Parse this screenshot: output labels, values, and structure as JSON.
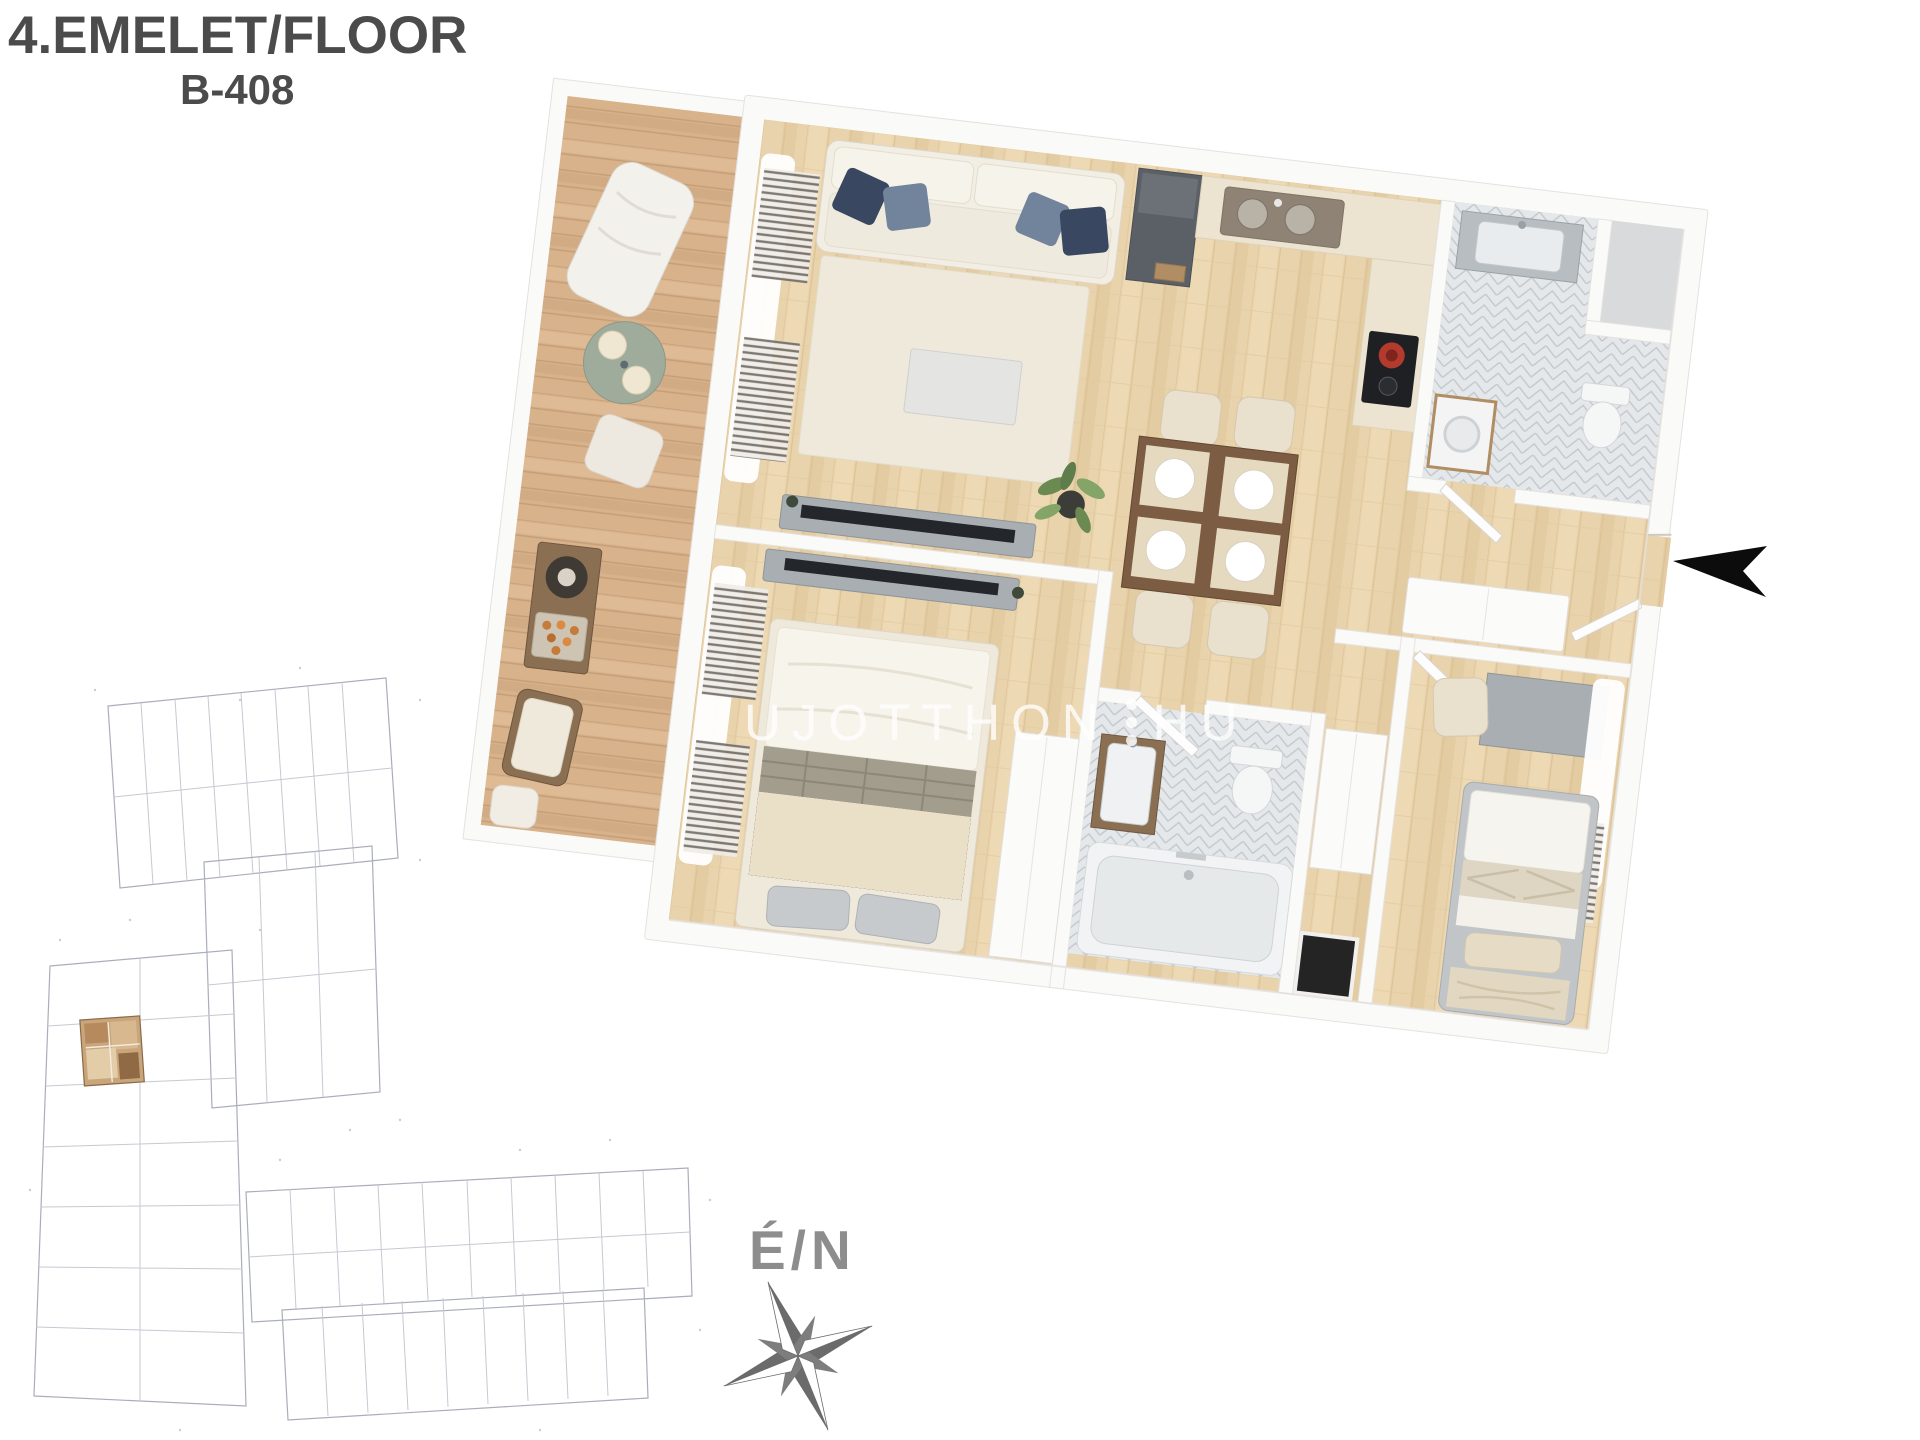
{
  "page": {
    "background": "#ffffff"
  },
  "header": {
    "title": "4.EMELET/FLOOR",
    "unit_code": "B-408",
    "text_color": "#4b4b4b"
  },
  "watermark": {
    "part1": "UJOTTHON",
    "part2": "HU",
    "separator": "vertical-three-dots",
    "color": "#ffffff"
  },
  "compass": {
    "label": "É/N",
    "icon": "compass-rose-icon",
    "label_color": "#8d8d8d",
    "star_color": "#6b6b6b"
  },
  "entrance_arrow": {
    "icon": "entrance-arrow-icon",
    "direction": "left",
    "color": "#0c0c0c"
  },
  "floorplan": {
    "type": "3d-apartment-top-view",
    "rotation_deg": 6.8,
    "rooms": [
      "terrace",
      "living-room",
      "kitchen",
      "dining-area",
      "bathroom-1",
      "storage-closet",
      "hallway",
      "bedroom-1",
      "bathroom-2",
      "bedroom-2"
    ],
    "colors": {
      "page-bg": "#ffffff",
      "title-color": "#4b4b4b",
      "wm-color": "#ffffff",
      "compass-text": "#8d8d8d",
      "wall": "#fafaf9",
      "wall-edge": "#e5e2df",
      "wood": "#e9d3ac",
      "wood-seam": "#dcc294",
      "terrace-wood": "#d8b28b",
      "terrace-seam": "#c49e78",
      "tile": "#e5e8ea",
      "tile-line": "#c2c8cd",
      "rug": "#eee9db",
      "sofa": "#f2eee3",
      "pillow-navy": "#3a4760",
      "pillow-slate": "#72839c",
      "furn-gray": "#a9aeb2",
      "furn-dark": "#5b6066",
      "counter": "#ece4d0",
      "cream": "#e9e0cd",
      "siteplan-line": "#c6c9d2",
      "siteplan-line2": "#aaaeb9",
      "siteplan-highlight": "#c9a57c"
    }
  }
}
